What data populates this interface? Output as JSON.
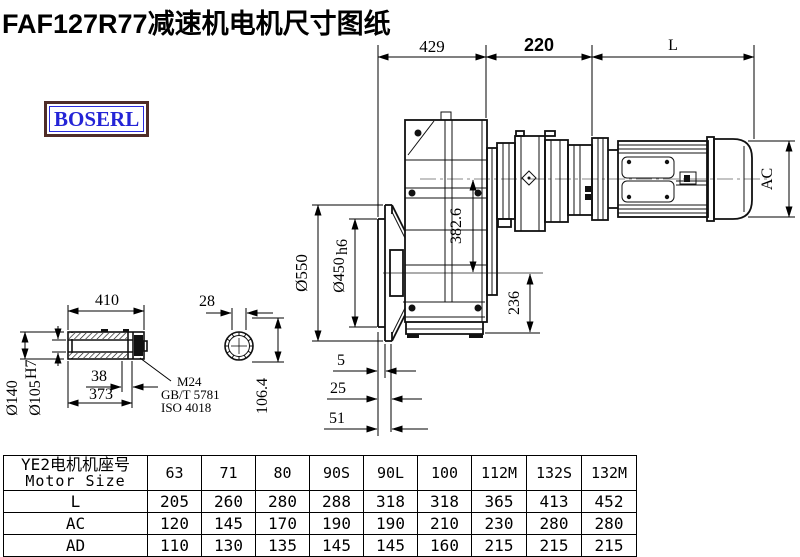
{
  "page": {
    "title": "FAF127R77减速机电机尺寸图纸"
  },
  "logo": {
    "text": "BOSERL",
    "text_color": "#2424d6",
    "border_color": "#4f2d28"
  },
  "dims": {
    "gearbox_width": "429",
    "adapter_length": "220",
    "motor_length": "L",
    "flange_od": "Ø550",
    "spigot_d": "Ø450",
    "spigot_tol": "h6",
    "axis_distance": "382.6",
    "center_to_base": "236",
    "face_offset": "5",
    "face_step": "25",
    "face_total": "51",
    "motor_od": "AC",
    "shaft_total": "410",
    "cap_width": "38",
    "shaft_body": "373",
    "hub_od": "Ø140",
    "bore_d": "Ø105",
    "bore_tol": "H7",
    "end_width": "28",
    "end_height": "106.4",
    "bolt_spec": "M24",
    "bolt_std_gb": "GB/T 5781",
    "bolt_std_iso": "ISO 4018"
  },
  "table": {
    "header_cn": "YE2电机机座号",
    "header_en": "Motor Size",
    "sizes": [
      "63",
      "71",
      "80",
      "90S",
      "90L",
      "100",
      "112M",
      "132S",
      "132M"
    ],
    "rows": [
      {
        "label": "L",
        "values": [
          "205",
          "260",
          "280",
          "288",
          "318",
          "318",
          "365",
          "413",
          "452"
        ]
      },
      {
        "label": "AC",
        "values": [
          "120",
          "145",
          "170",
          "190",
          "190",
          "210",
          "230",
          "280",
          "280"
        ]
      },
      {
        "label": "AD",
        "values": [
          "110",
          "130",
          "135",
          "145",
          "145",
          "160",
          "215",
          "215",
          "215"
        ]
      }
    ]
  }
}
